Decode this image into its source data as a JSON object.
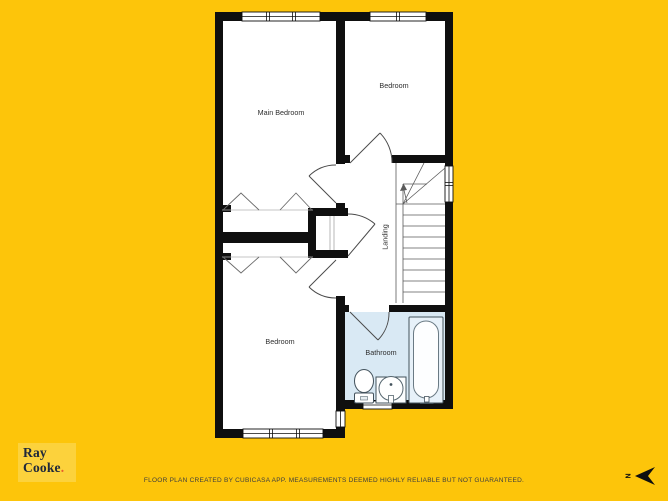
{
  "branding": {
    "logo_line1": "Ray",
    "logo_line2": "Cooke",
    "logo_dot": "."
  },
  "footer": {
    "disclaimer": "FLOOR PLAN CREATED BY CUBICASA APP. MEASUREMENTS DEEMED HIGHLY RELIABLE BUT NOT GUARANTEED."
  },
  "compass": {
    "north_label": "N"
  },
  "floor_plan": {
    "rooms": [
      {
        "id": "main-bedroom",
        "label": "Main Bedroom"
      },
      {
        "id": "bedroom-top",
        "label": "Bedroom"
      },
      {
        "id": "landing",
        "label": "Landing"
      },
      {
        "id": "bedroom-bottom",
        "label": "Bedroom"
      },
      {
        "id": "bathroom",
        "label": "Bathroom"
      }
    ],
    "fixtures": [
      "stairs-up",
      "bathtub",
      "toilet",
      "sink",
      "wardrobe-main-bedroom",
      "wardrobe-bedroom-bottom",
      "closet"
    ],
    "window_count": 6,
    "door_count": 5
  },
  "colors": {
    "background": "#fdc50a",
    "logo_background": "#fcd23c",
    "logo_text": "#20293a",
    "logo_dot": "#e95b2b",
    "wall": "#0f0f0f",
    "bathroom_floor": "#d9e9f4",
    "disclaimer_text": "#3e3e3e"
  }
}
